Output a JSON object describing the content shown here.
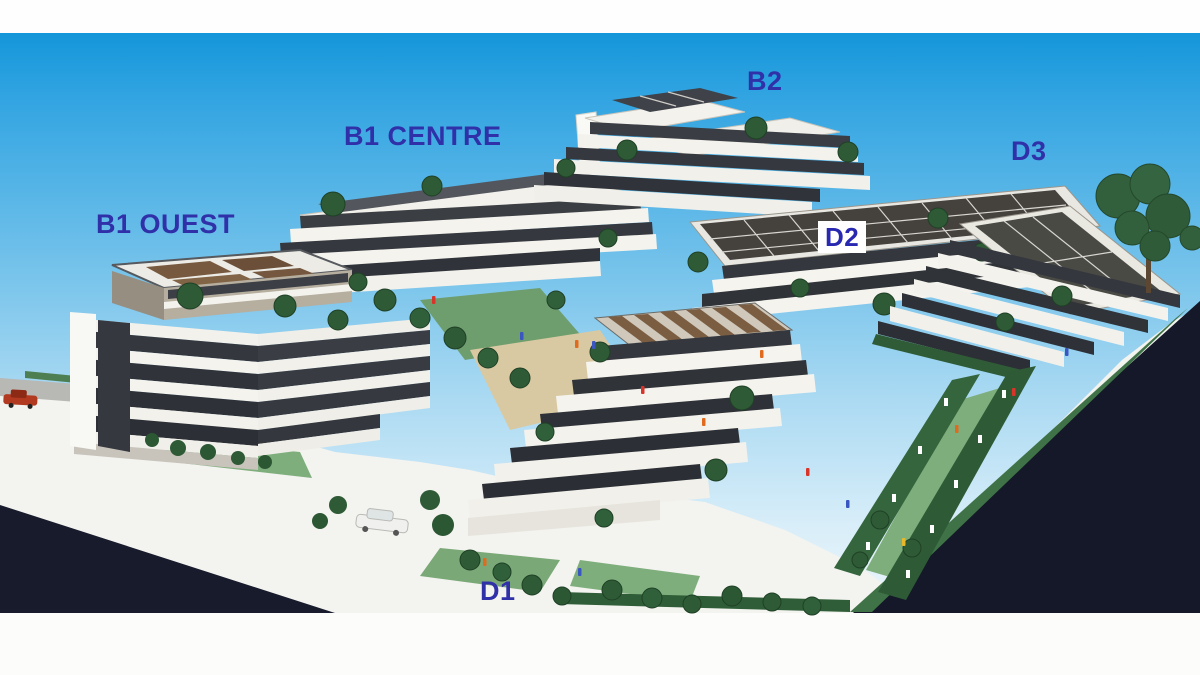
{
  "scene": {
    "description": "Photograph of an architectural scale model of an apartment complex with labelled buildings",
    "labels": [
      {
        "id": "b1-ouest",
        "text": "B1 OUEST"
      },
      {
        "id": "b1-centre",
        "text": "B1 CENTRE"
      },
      {
        "id": "b2",
        "text": "B2"
      },
      {
        "id": "d2",
        "text": "D2"
      },
      {
        "id": "d3",
        "text": "D3"
      },
      {
        "id": "d1",
        "text": "D1"
      }
    ],
    "colors": {
      "label_text": "#3030a8",
      "label_d2_background": "#ffffff",
      "sky_top": "#1496da",
      "sky_horizon": "#ecf6fb",
      "top_strip": "#fefefe",
      "road_dark": "#151a2b",
      "base_white": "#f3f3ef",
      "building_white": "#f4f3ee",
      "window_band_dark": "#33363c",
      "roof_panel_brown": "#7b5d42",
      "solar_roof_dark": "#45413d",
      "tree_green": "#2e5a35",
      "lawn_green": "#7fae7d",
      "sand_path": "#d9c9a2",
      "red_car": "#b23a20",
      "white_car": "#f0f1ee"
    }
  }
}
